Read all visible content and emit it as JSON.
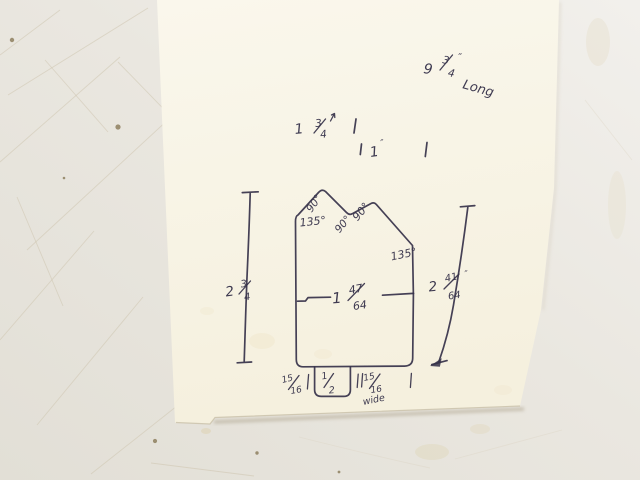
{
  "colors": {
    "ink": "#353149",
    "paper": "#f8f4e6",
    "surface": "#eae7e0",
    "scratch": "#cdc4ae"
  },
  "sketch": {
    "length_note": {
      "whole": "9",
      "num": "3",
      "den": "4",
      "quote": "″",
      "word": "Long"
    },
    "top_row1": {
      "lead": "1",
      "num": "3",
      "den": "4"
    },
    "top_row2": {
      "value": "1",
      "quote": "″"
    },
    "mid_width": {
      "whole": "1",
      "num": "47",
      "den": "64"
    },
    "left_height": {
      "whole": "2",
      "num": "3",
      "den": "4"
    },
    "right_height": {
      "whole": "2",
      "num": "41",
      "den": "64",
      "quote": "″"
    },
    "bottom_left_width": {
      "num": "15",
      "den": "16"
    },
    "tab_width": {
      "num": "1",
      "den": "2"
    },
    "bottom_right_width": {
      "num": "15",
      "den": "16",
      "word": "wide"
    },
    "angles": {
      "left_peak": "90°",
      "left_shoulder": "135°",
      "valley_left": "90°",
      "valley_right": "90°",
      "right_shoulder": "135°"
    }
  }
}
